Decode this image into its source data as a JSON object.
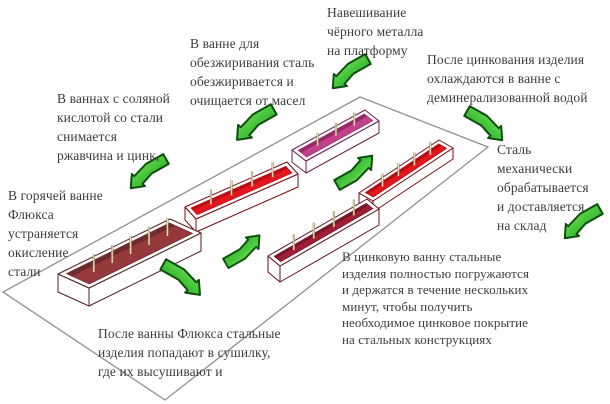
{
  "figure": {
    "background": "#ffffff",
    "text_color": "#3d3d3d",
    "platform": {
      "points": [
        [
          360,
          97
        ],
        [
          488,
          147
        ],
        [
          165,
          400
        ],
        [
          3,
          292
        ]
      ],
      "fill": "#ffffff",
      "stroke": "#909090"
    },
    "labels": [
      {
        "id": "hang-black-metal",
        "x": 327,
        "y": 3,
        "lines": [
          "Навешивание",
          "чёрного металла",
          "на платформу"
        ]
      },
      {
        "id": "degreasing-bath",
        "x": 190,
        "y": 34,
        "lines": [
          "В ванне для",
          "обезжиривания сталь",
          "обезжиривается и",
          "очищается от масел"
        ]
      },
      {
        "id": "acid-bath",
        "x": 57,
        "y": 89,
        "lines": [
          "В ваннах с соляной",
          "кислотой со стали",
          "снимается",
          "ржавчина и цинк,"
        ]
      },
      {
        "id": "flux-bath",
        "x": 8,
        "y": 186,
        "lines": [
          "В горячей ванне",
          "Флюкса",
          "устраняется",
          "окисление",
          "стали"
        ]
      },
      {
        "id": "cooling-bath",
        "x": 427,
        "y": 50,
        "lines": [
          "После цинкования изделия",
          "охлаждаются в ванне с",
          "деминерализованной водой"
        ]
      },
      {
        "id": "to-warehouse",
        "x": 497,
        "y": 140,
        "lines": [
          "Сталь",
          "механически",
          "обрабатывается",
          "и доставляется",
          "на склад"
        ]
      },
      {
        "id": "zinc-bath",
        "x": 342,
        "y": 249,
        "tight": true,
        "lines": [
          "В цинковую ванну стальные",
          "изделия полностью погружаются",
          "и держатся в течение нескольких",
          "минут, чтобы получить",
          "необходимое цинковое покрытие",
          "на стальных конструкциях"
        ]
      },
      {
        "id": "dryer",
        "x": 98,
        "y": 324,
        "lines": [
          "После ванны Флюкса стальные",
          "изделия попадают в сушилку,",
          "где их высушивают и"
        ]
      }
    ],
    "baths": [
      {
        "id": "bath-degreasing",
        "p": [
          292,
          150
        ],
        "l": [
          73,
          -40
        ],
        "w": [
          14,
          11
        ],
        "h": 12,
        "inset": 4,
        "color": "#c2418d",
        "wall": "#97296b",
        "stroke": "#6b2150",
        "pins": 3,
        "pin_h": 13
      },
      {
        "id": "bath-cooling",
        "p": [
          359,
          193
        ],
        "l": [
          80,
          -53
        ],
        "w": [
          14,
          8
        ],
        "h": 11,
        "inset": 4,
        "color": "#e5161e",
        "wall": "#b30d13",
        "stroke": "#7a0c10",
        "pins": 4,
        "pin_h": 13
      },
      {
        "id": "bath-acid",
        "p": [
          185,
          207
        ],
        "l": [
          102,
          -45
        ],
        "w": [
          11,
          12
        ],
        "h": 13,
        "inset": 4,
        "color": "#e5161e",
        "wall": "#bb0e15",
        "stroke": "#7a0c10",
        "pins": 4,
        "pin_h": 15
      },
      {
        "id": "bath-zinc",
        "p": [
          268,
          256
        ],
        "l": [
          99,
          -57
        ],
        "w": [
          12,
          10
        ],
        "h": 16,
        "inset": 4,
        "color": "#a21e32",
        "wall": "#77152a",
        "stroke": "#5c1020",
        "pins": 4,
        "pin_h": 16
      },
      {
        "id": "bath-flux",
        "p": [
          58,
          274
        ],
        "l": [
          112,
          -55
        ],
        "w": [
          31,
          14
        ],
        "h": 18,
        "inset": 5,
        "color": "#96393d",
        "wall": "#702a2e",
        "stroke": "#532023",
        "pins": 5,
        "pin_h": 18
      }
    ],
    "arrows": [
      {
        "id": "arrow-to-platform",
        "x": 326,
        "y": 50,
        "size": 48,
        "dir": "down-left"
      },
      {
        "id": "arrow-to-degreasing",
        "x": 230,
        "y": 100,
        "size": 50,
        "dir": "down-left"
      },
      {
        "id": "arrow-to-acid",
        "x": 124,
        "y": 150,
        "size": 48,
        "dir": "down-left"
      },
      {
        "id": "arrow-flux-to-dryer",
        "x": 157,
        "y": 255,
        "size": 50,
        "dir": "down-right"
      },
      {
        "id": "arrow-dryer-to-zinc",
        "x": 220,
        "y": 226,
        "size": 46,
        "dir": "up-right"
      },
      {
        "id": "arrow-zinc-to-cooling",
        "x": 331,
        "y": 146,
        "size": 48,
        "dir": "up-right"
      },
      {
        "id": "arrow-to-cooling",
        "x": 461,
        "y": 102,
        "size": 48,
        "dir": "down-right"
      },
      {
        "id": "arrow-to-warehouse",
        "x": 558,
        "y": 200,
        "size": 48,
        "dir": "down-left"
      }
    ],
    "arrow_colors": {
      "light": "#a8f07a",
      "mid": "#4cc93f",
      "dark": "#169114",
      "outline": "#0b4e0b"
    },
    "pin_colors": {
      "outline": "#9b8a63",
      "fill": "#ece0c4"
    },
    "rim_color": "#ffffff"
  }
}
